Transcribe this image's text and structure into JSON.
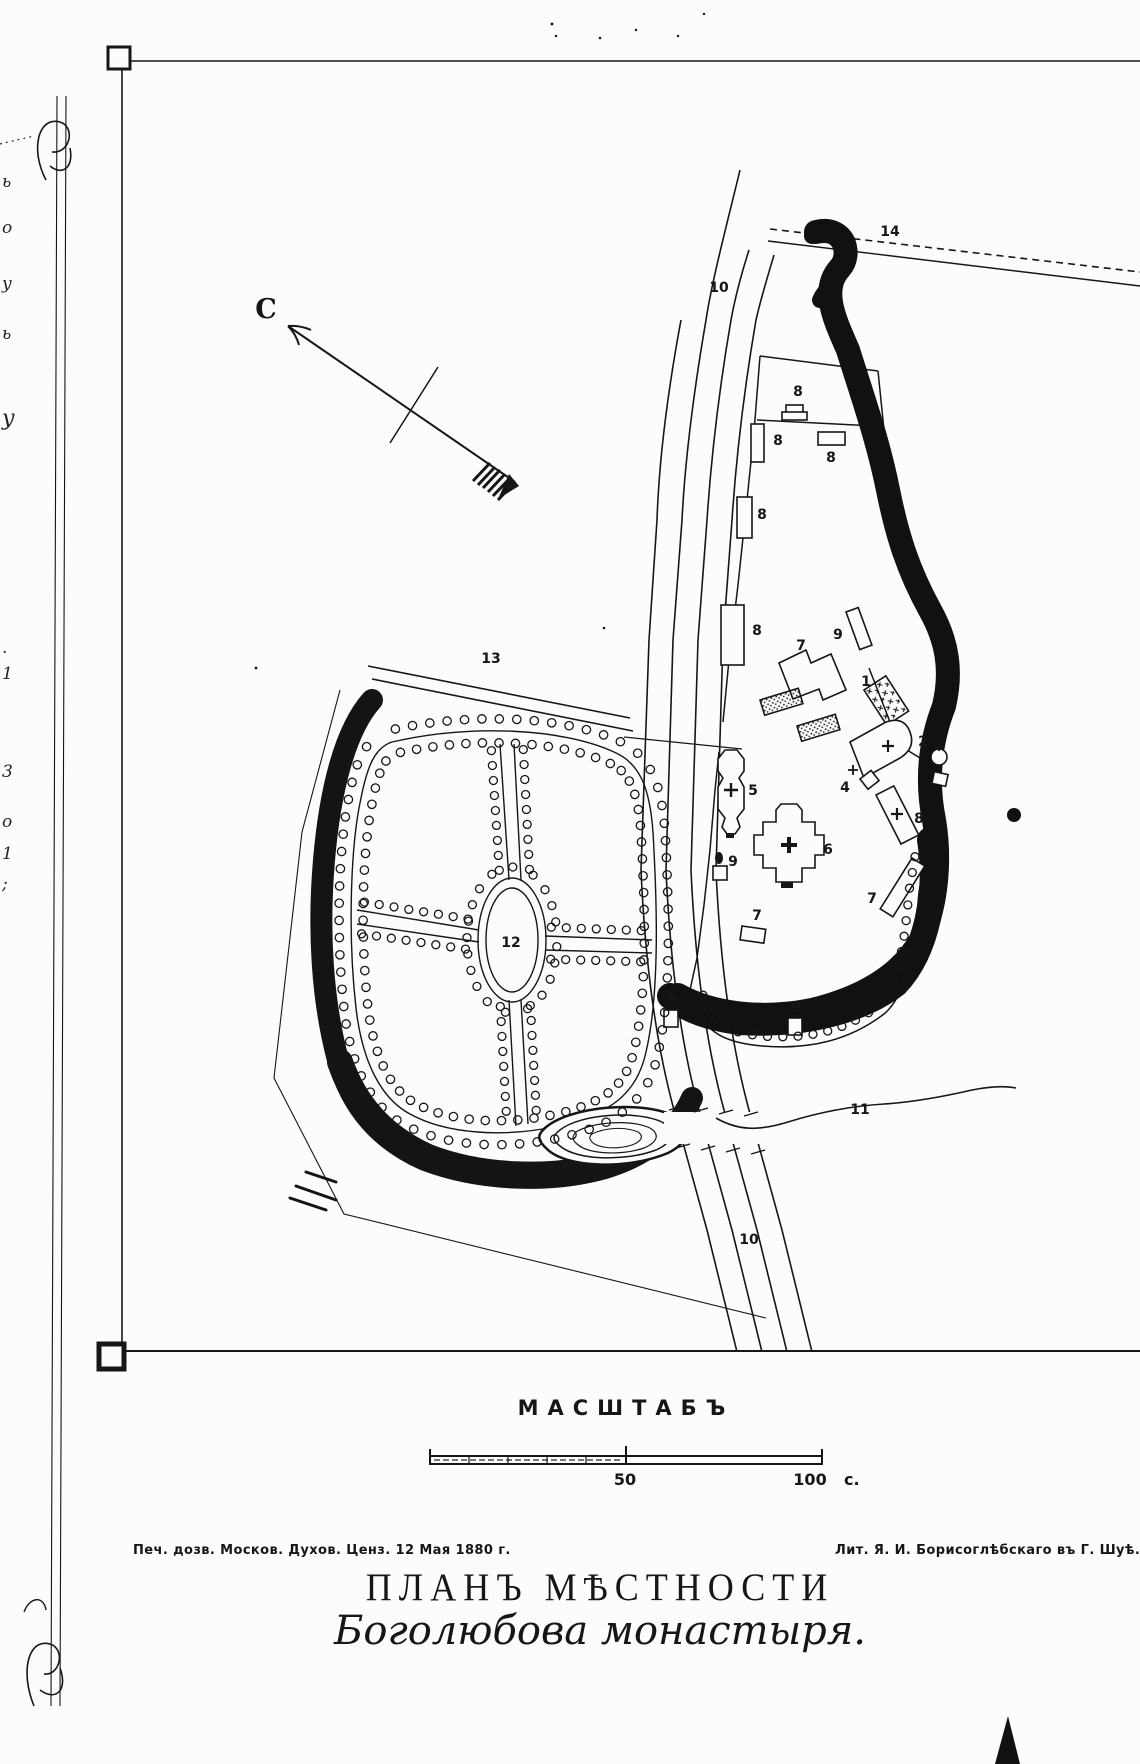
{
  "colors": {
    "ink": "#161616",
    "paper": "#fcfcfa"
  },
  "title": {
    "line1": "ПЛАНЪ МѢСТНОСТИ",
    "line2": "Боголюбова монастыря."
  },
  "scale": {
    "heading": "МАСШТАБЪ",
    "mid": "50",
    "end": "100",
    "unit": "с."
  },
  "imprint": {
    "left": "Печ. дозв. Москов. Духов. Ценз. 12  Мая 1880 г.",
    "right": "Лит. Я. И. Борисоглѣбскаго въ Г. Шуѣ."
  },
  "compass": {
    "north": "С"
  },
  "map_labels": [
    {
      "t": "С",
      "x": 266,
      "y": 318,
      "cls": "compass"
    },
    {
      "t": "10",
      "x": 719,
      "y": 292
    },
    {
      "t": "10",
      "x": 749,
      "y": 1244
    },
    {
      "t": "13",
      "x": 491,
      "y": 663
    },
    {
      "t": "14",
      "x": 890,
      "y": 236
    },
    {
      "t": "12",
      "x": 511,
      "y": 947,
      "s": 17
    },
    {
      "t": "5",
      "x": 753,
      "y": 795
    },
    {
      "t": "6",
      "x": 828,
      "y": 854
    },
    {
      "t": "7",
      "x": 801,
      "y": 650
    },
    {
      "t": "7",
      "x": 872,
      "y": 903
    },
    {
      "t": "7",
      "x": 757,
      "y": 920
    },
    {
      "t": "1",
      "x": 866,
      "y": 686
    },
    {
      "t": "2",
      "x": 923,
      "y": 746
    },
    {
      "t": "4",
      "x": 845,
      "y": 792
    },
    {
      "t": "8",
      "x": 798,
      "y": 396
    },
    {
      "t": "8",
      "x": 778,
      "y": 445
    },
    {
      "t": "8",
      "x": 831,
      "y": 462
    },
    {
      "t": "8",
      "x": 762,
      "y": 519
    },
    {
      "t": "8",
      "x": 757,
      "y": 635
    },
    {
      "t": "8",
      "x": 919,
      "y": 823
    },
    {
      "t": "9",
      "x": 838,
      "y": 639
    },
    {
      "t": "9",
      "x": 733,
      "y": 866
    },
    {
      "t": "9",
      "x": 671,
      "y": 1004
    },
    {
      "t": "9",
      "x": 796,
      "y": 1012
    },
    {
      "t": "11",
      "x": 860,
      "y": 1114
    },
    {
      "t": "11",
      "x": 571,
      "y": 1172
    }
  ],
  "margin_fragments": [
    {
      "t": "ь",
      "y": 184
    },
    {
      "t": "о",
      "y": 230
    },
    {
      "t": "у",
      "y": 286
    },
    {
      "t": "ь",
      "y": 336
    },
    {
      "t": "у",
      "y": 418,
      "s": 22
    },
    {
      "t": ".",
      "y": 650
    },
    {
      "t": "1",
      "y": 676
    },
    {
      "t": "3",
      "y": 774
    },
    {
      "t": "о",
      "y": 824
    },
    {
      "t": "1",
      "y": 856
    },
    {
      "t": ";",
      "y": 886
    }
  ]
}
